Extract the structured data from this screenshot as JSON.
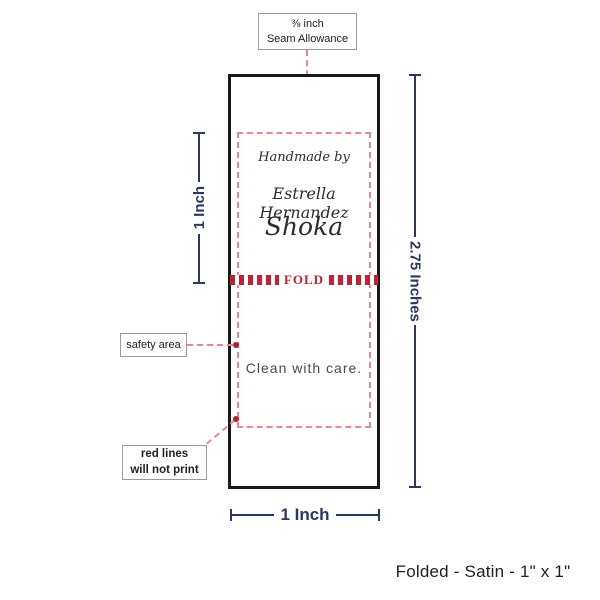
{
  "colors": {
    "navy": "#2b3764",
    "fold_red": "#c02233",
    "dash_pink": "#f0858d",
    "dot_red": "#b51f2b",
    "label_border": "#1a1a1a",
    "callout_border": "#9a9a9a"
  },
  "seam_callout": {
    "line1": "⅜ inch",
    "line2": "Seam Allowance"
  },
  "safety_callout": {
    "label": "safety area"
  },
  "redlines_callout": {
    "line1": "red lines",
    "line2": "will not print"
  },
  "label_content": {
    "handmade_by": "Handmade by",
    "maker_name": "Estrella Hernandez",
    "brand_name": "Shoka",
    "fold_label": "FOLD",
    "care_text": "Clean with care."
  },
  "measurements": {
    "left_label": "1 Inch",
    "right_label": "2.75 Inches",
    "bottom_label": "1 Inch"
  },
  "footer_caption": "Folded - Satin - 1\" x 1\""
}
